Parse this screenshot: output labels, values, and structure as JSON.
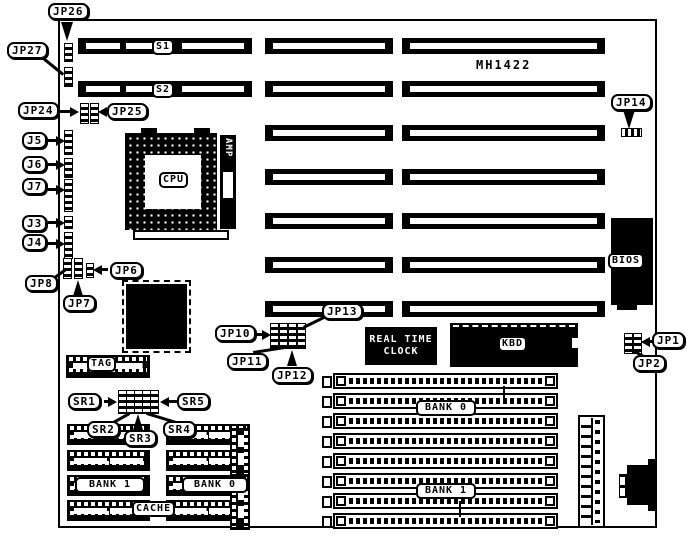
{
  "board": {
    "model": "MH1422"
  },
  "colors": {
    "ink": "#000000",
    "paper": "#ffffff"
  },
  "structure": {
    "expansion_slot_rows": 7,
    "simm_slots": 8,
    "cache_chip_rows": 4,
    "cache_chip_columns": 2
  },
  "slots": {
    "s1": "S1",
    "s2": "S2"
  },
  "chips": {
    "cpu": "CPU",
    "amp": "AMP",
    "bios": "BIOS",
    "kbd": "KBD",
    "tag": "TAG",
    "rtc_line1": "REAL TIME",
    "rtc_line2": "CLOCK"
  },
  "memory": {
    "simm_bank0": "BANK 0",
    "simm_bank1": "BANK 1",
    "cache_bank0": "BANK 0",
    "cache_bank1": "BANK 1",
    "cache": "CACHE"
  },
  "callouts": {
    "jp26": "JP26",
    "jp27": "JP27",
    "jp24": "JP24",
    "jp25": "JP25",
    "j5": "J5",
    "j6": "J6",
    "j7": "J7",
    "j3": "J3",
    "j4": "J4",
    "jp8": "JP8",
    "jp7": "JP7",
    "jp6": "JP6",
    "jp10": "JP10",
    "jp11": "JP11",
    "jp12": "JP12",
    "jp13": "JP13",
    "jp14": "JP14",
    "jp1": "JP1",
    "jp2": "JP2",
    "sr1": "SR1",
    "sr2": "SR2",
    "sr3": "SR3",
    "sr4": "SR4",
    "sr5": "SR5"
  }
}
